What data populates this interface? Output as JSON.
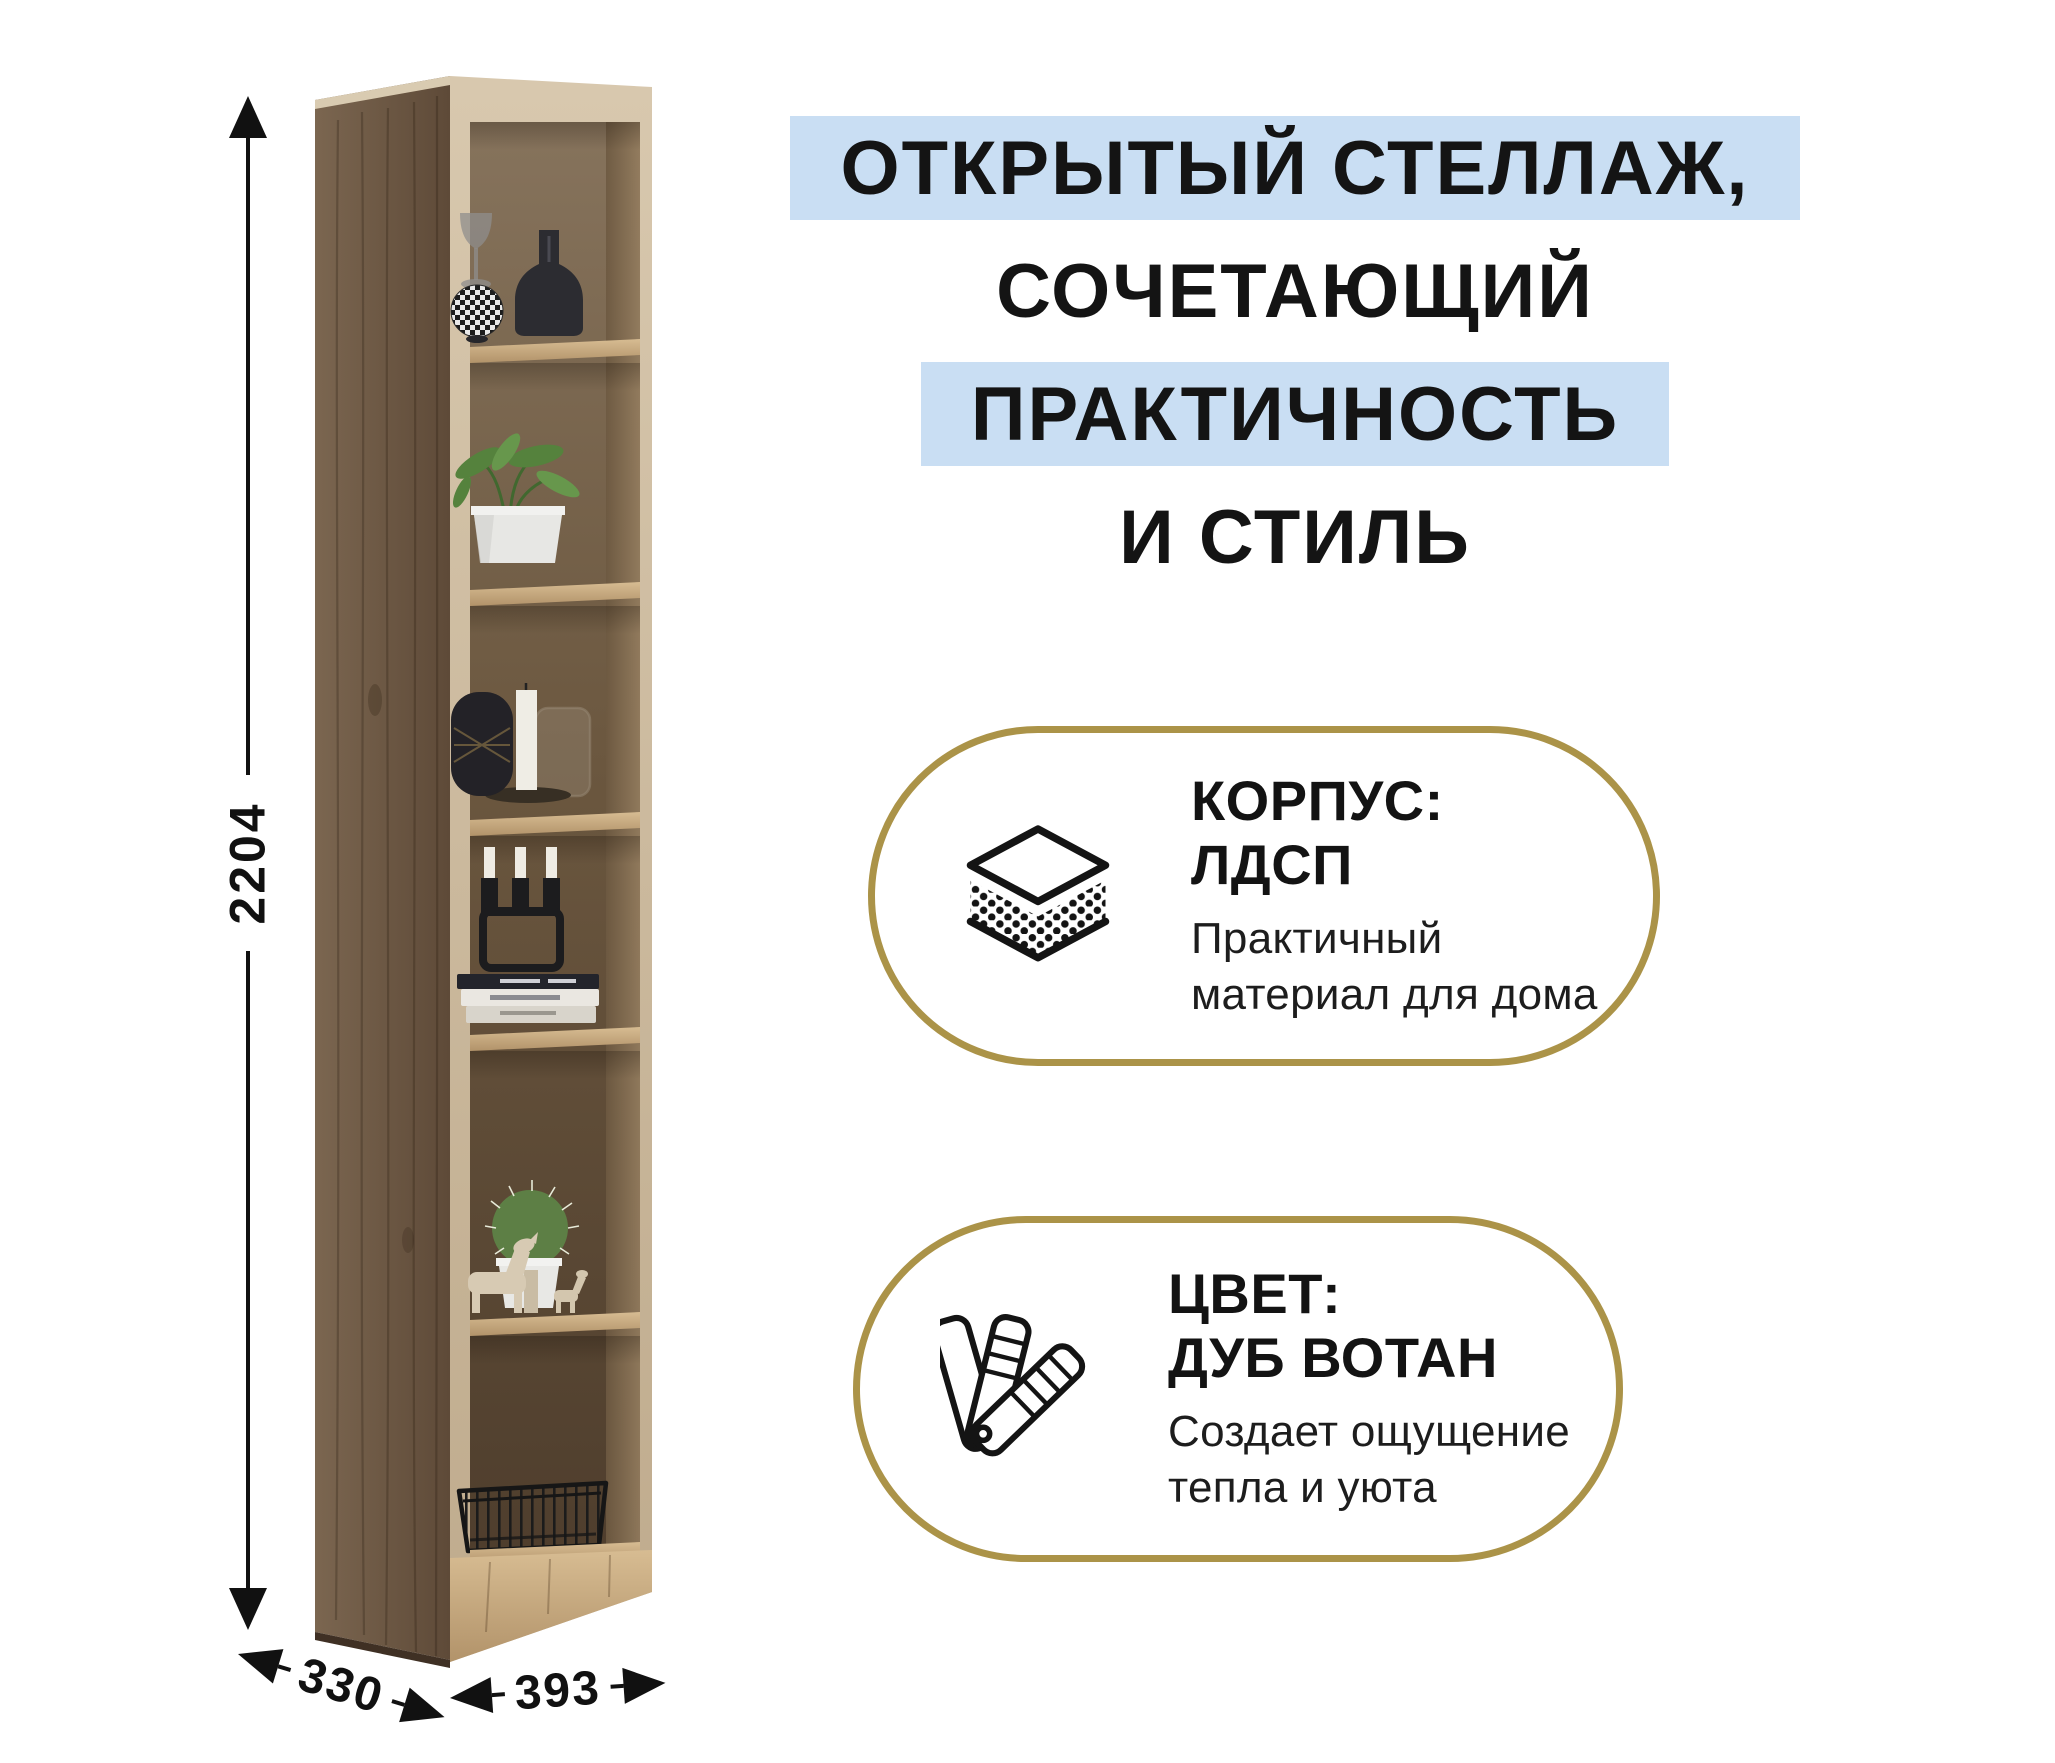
{
  "page": {
    "background": "#ffffff"
  },
  "colors": {
    "highlight_blue": "#C9DEF3",
    "accent_gold": "#AB9348",
    "text": "#141414",
    "wood_side": "#6E5945",
    "wood_front": "#CDBBA0",
    "wood_shelf": "#C4A87E",
    "interior_dark": "#5A4936"
  },
  "headline": {
    "lines": [
      {
        "text": "ОТКРЫТЫЙ СТЕЛЛАЖ,",
        "highlighted": true
      },
      {
        "text": "СОЧЕТАЮЩИЙ",
        "highlighted": false
      },
      {
        "text": "ПРАКТИЧНОСТЬ",
        "highlighted": true
      },
      {
        "text": "И СТИЛЬ",
        "highlighted": false
      }
    ]
  },
  "cards": [
    {
      "icon": "layers-chipboard-icon",
      "title": "КОРПУС: ЛДСП",
      "subtitle_line1": "Практичный",
      "subtitle_line2": "материал для дома"
    },
    {
      "icon": "color-swatches-fan-icon",
      "title_line1": "ЦВЕТ:",
      "title_line2": "ДУБ ВОТАН",
      "subtitle_line1": "Создает ощущение",
      "subtitle_line2": "тепла и уюта"
    }
  ],
  "dimensions": {
    "height": "2204",
    "depth": "330",
    "width": "393"
  },
  "shelf": {
    "type": "open shelving unit, 6 cells, oak wotan wood",
    "cells": [
      {
        "items": "decorative sphere vase, dark bottle vase, goblet"
      },
      {
        "items": "green plant in white pot"
      },
      {
        "items": "lantern jar, white candle on plate, glass jar"
      },
      {
        "items": "black candelabra with 3 candles, stacked magazines"
      },
      {
        "items": "cactus in white pot, wooden animal figurines"
      },
      {
        "items": "black wire basket"
      }
    ]
  }
}
